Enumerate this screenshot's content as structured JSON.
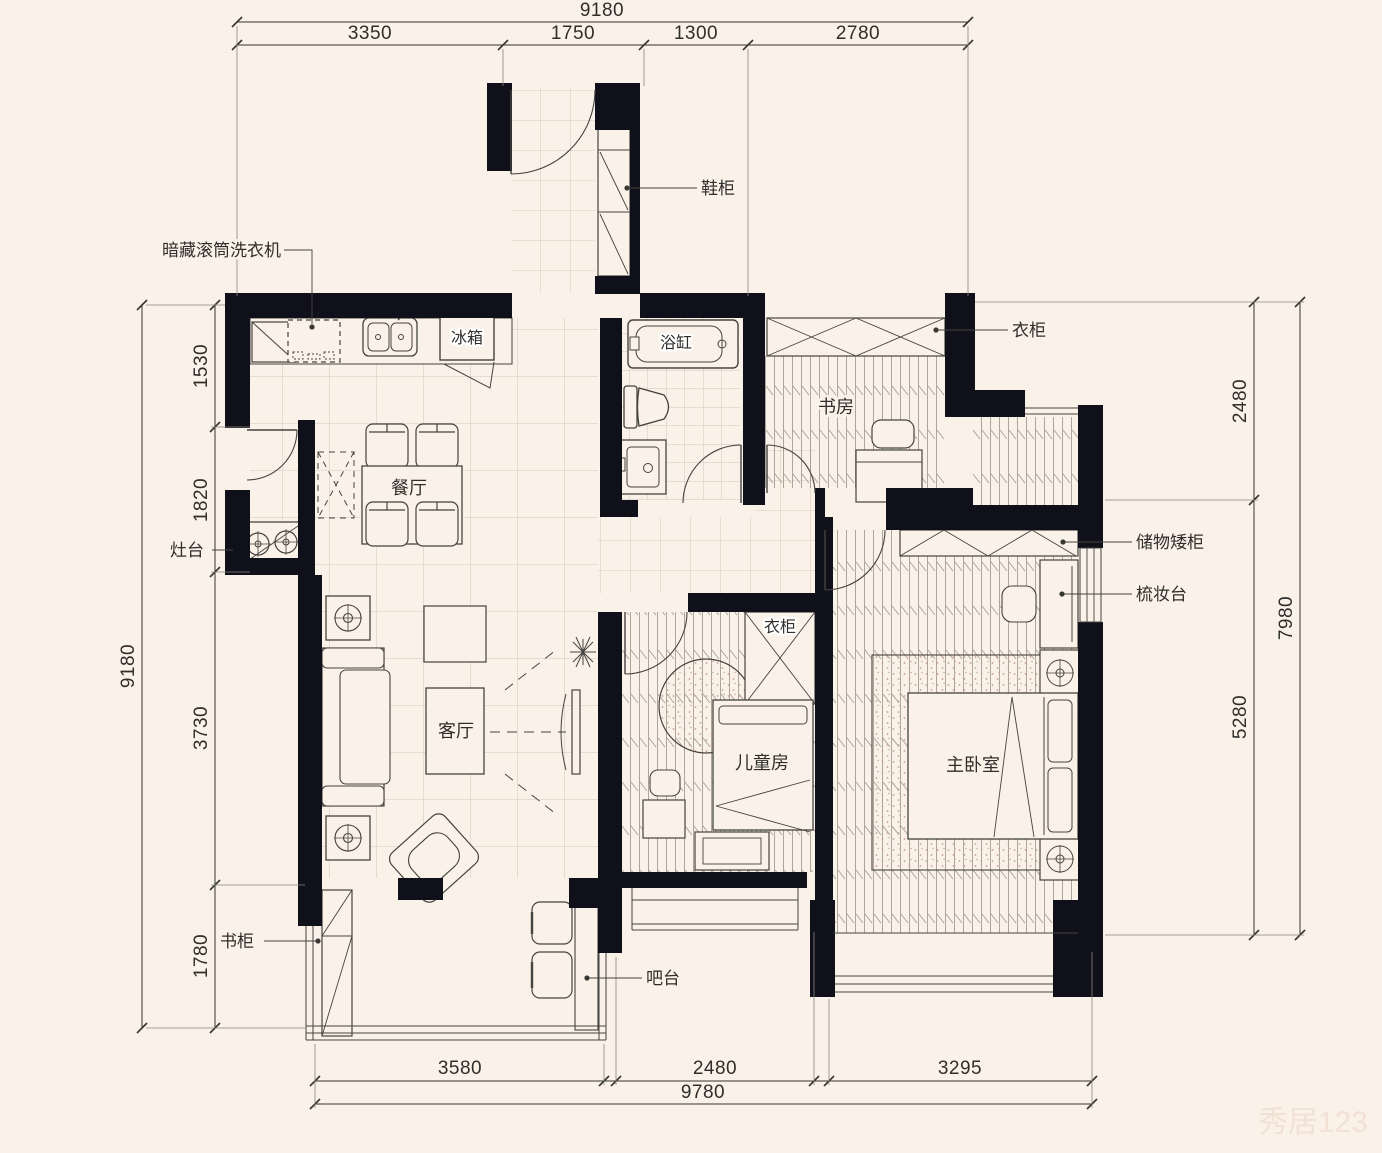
{
  "colors": {
    "background": "#faf1e8",
    "wall": "#10101a",
    "line": "#45433f",
    "dimension_text": "#2f2e2b",
    "grid": "#c6bbae",
    "rug_dots": "#c59e8c"
  },
  "dimensions": {
    "top": {
      "total": "9180",
      "segments": [
        "3350",
        "1750",
        "1300",
        "2780"
      ]
    },
    "left": {
      "total": "9180",
      "segments": [
        "1530",
        "1820",
        "3730",
        "1780"
      ]
    },
    "right": {
      "total": "7980",
      "segments": [
        "2480",
        "5280"
      ]
    },
    "bottom": {
      "total": "9780",
      "segments": [
        "3580",
        "2480",
        "3295"
      ]
    }
  },
  "rooms": {
    "dining": "餐厅",
    "living": "客厅",
    "study": "书房",
    "kids_room": "儿童房",
    "master_bedroom": "主卧室"
  },
  "annotations": {
    "washer": "暗藏滚筒洗衣机",
    "shoe_cabinet": "鞋柜",
    "fridge": "冰箱",
    "bathtub": "浴缸",
    "study_wardrobe": "衣柜",
    "stove": "灶台",
    "storage_cabinet": "储物矮柜",
    "dressing_table": "梳妆台",
    "kids_wardrobe": "衣柜",
    "bookcase": "书柜",
    "bar_counter": "吧台"
  },
  "watermark": "秀居123"
}
